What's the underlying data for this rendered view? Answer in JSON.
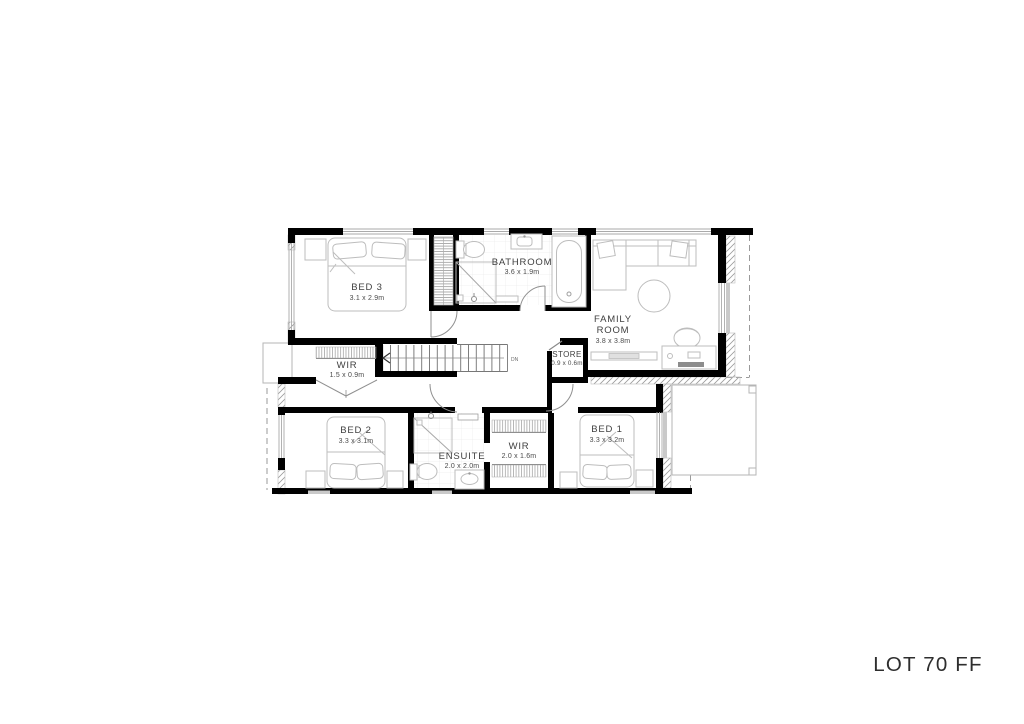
{
  "plan": {
    "rooms": [
      {
        "id": "bed-3",
        "name": "BED 3",
        "dims": "3.1 x 2.9m"
      },
      {
        "id": "bathroom",
        "name": "BATHROOM",
        "dims": "3.6 x 1.9m"
      },
      {
        "id": "family-room",
        "line1": "FAMILY",
        "line2": "ROOM",
        "dims": "3.8 x 3.8m"
      },
      {
        "id": "wir-upper",
        "name": "WIR",
        "dims": "1.5 x 0.9m"
      },
      {
        "id": "store",
        "name": "STORE",
        "dims": "0.9 x 0.6m"
      },
      {
        "id": "bed-2",
        "name": "BED 2",
        "dims": "3.3 x 3.1m"
      },
      {
        "id": "ensuite",
        "name": "ENSUITE",
        "dims": "2.0 x 2.0m"
      },
      {
        "id": "wir-lower",
        "name": "WIR",
        "dims": "2.0 x 1.6m"
      },
      {
        "id": "bed-1",
        "name": "BED 1",
        "dims": "3.3 x 3.2m"
      }
    ],
    "stairs_label": "DN"
  },
  "footer": {
    "lot_label": "LOT 70 FF"
  },
  "colors": {
    "wall": "#000000",
    "furniture_line": "#bdbdbd",
    "window_line": "#aaaaaa",
    "hatch_line": "#9b9b9b",
    "label_text": "#3f3f3f",
    "lot_text": "#2e2e2e",
    "dashed_line": "#9a9a9a"
  }
}
